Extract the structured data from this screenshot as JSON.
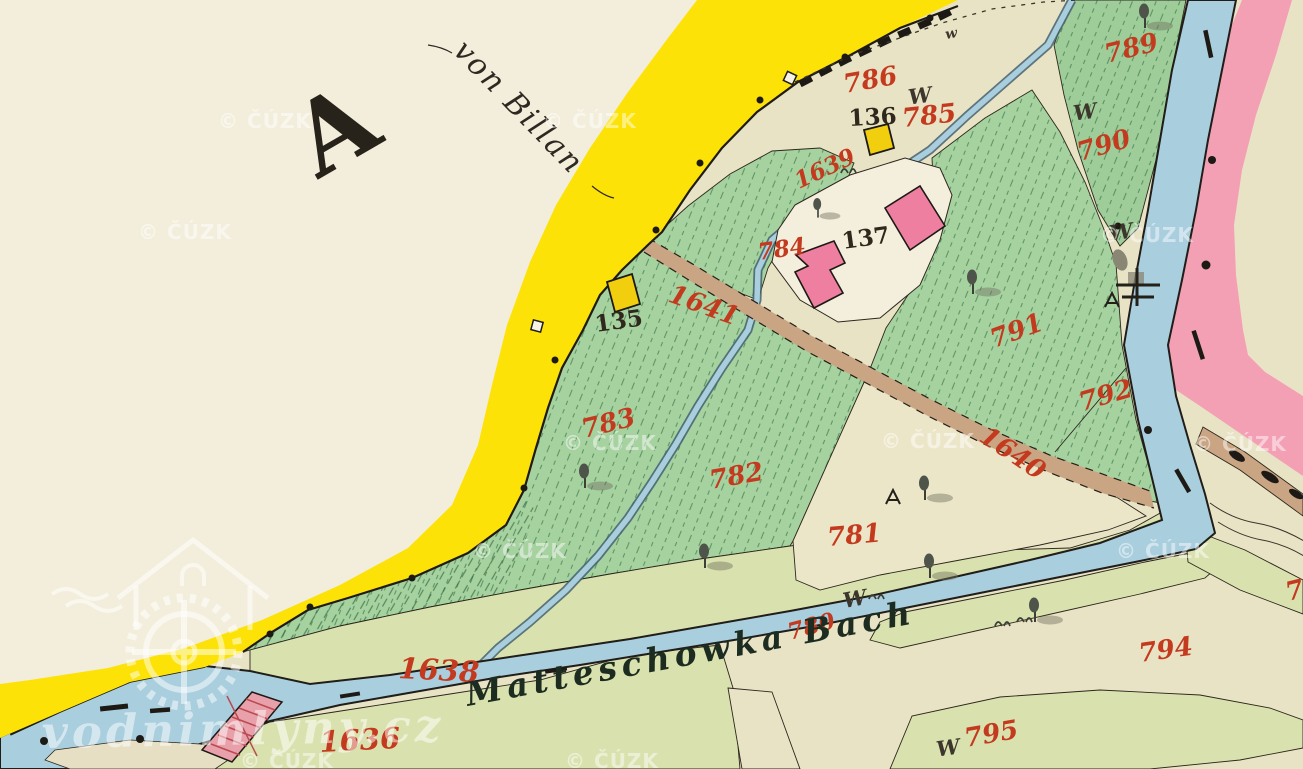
{
  "map": {
    "sheet_letter": "A",
    "place_name": "von Billan",
    "stream_name": "Matteschowka Bach",
    "meadow_mark": "W",
    "meadow_mark_small": "w",
    "parcels": {
      "780": "780",
      "781": "781",
      "782": "782",
      "783": "783",
      "784": "784",
      "785": "785",
      "786": "786",
      "789": "789",
      "790": "790",
      "791": "791",
      "792": "792",
      "794": "794",
      "795": "795",
      "partial_right_edge": "79"
    },
    "waterways": {
      "1636": "1636",
      "1638": "1638",
      "1639": "1639",
      "1640": "1640",
      "1641": "1641"
    },
    "buildings": {
      "135": "135",
      "136": "136",
      "137": "137"
    },
    "colors": {
      "paper": "#f3eedc",
      "parcel_beige": "#e9e3c5",
      "field_green": "#a6d2a0",
      "bank_green": "#d9e2ae",
      "road_yellow": "#fde208",
      "water_blue": "#a9cede",
      "boundary_pink": "#f3a0b5",
      "building_pink": "#ef7fa0",
      "building_yellow": "#f2cf0e",
      "road_brown": "#c9a583",
      "number_red": "#c43a1e",
      "ink": "#26211a"
    }
  },
  "watermarks": {
    "provider": "© ČÚZK",
    "site": "vodnimlyny.cz"
  }
}
